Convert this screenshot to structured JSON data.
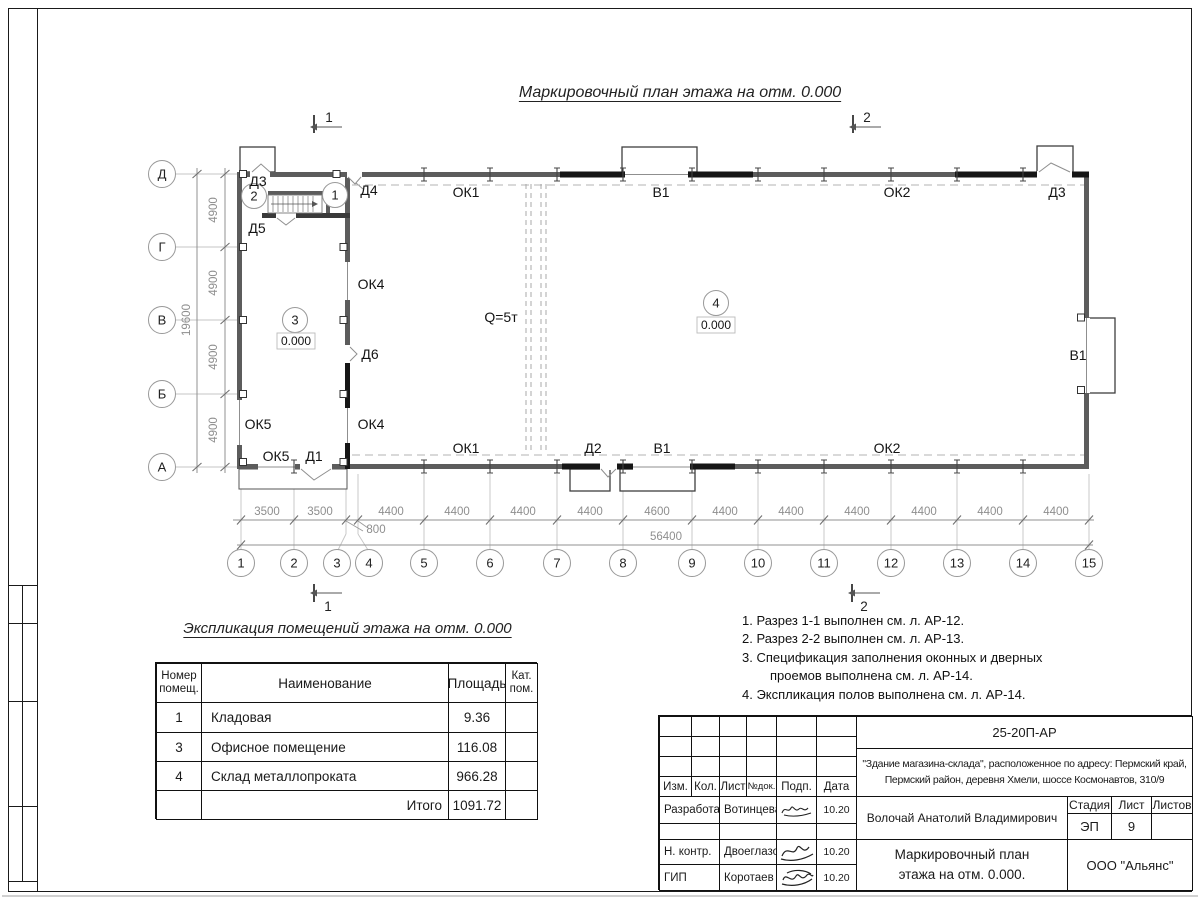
{
  "titles": {
    "plan": "Маркировочный план этажа на отм. 0.000",
    "table": "Экспликация помещений этажа на отм. 0.000"
  },
  "plan": {
    "row_axes": [
      "Д",
      "Г",
      "В",
      "Б",
      "А"
    ],
    "col_axes": [
      "1",
      "2",
      "3",
      "4",
      "5",
      "6",
      "7",
      "8",
      "9",
      "10",
      "11",
      "12",
      "13",
      "14",
      "15"
    ],
    "dims_left": [
      "4900",
      "4900",
      "4900",
      "4900"
    ],
    "dim_left_total": "19600",
    "dims_bottom": [
      "3500",
      "3500",
      "4400",
      "4400",
      "4400",
      "4400",
      "4600",
      "4400",
      "4400",
      "4400",
      "4400",
      "4400",
      "4400"
    ],
    "dim_offset": "800",
    "dim_bottom_total": "56400",
    "labels": {
      "ok1": "ОК1",
      "ok2": "ОК2",
      "ok4": "ОК4",
      "ok5": "ОК5",
      "v1": "В1",
      "d1": "Д1",
      "d2": "Д2",
      "d3": "Д3",
      "d4": "Д4",
      "d5": "Д5",
      "d6": "Д6",
      "crane": "Q=5т",
      "level": "0.000"
    },
    "rooms": [
      "1",
      "2",
      "3",
      "4"
    ],
    "sections": {
      "s1": "1",
      "s2": "2"
    }
  },
  "table": {
    "headers": {
      "num": "Номер помещ.",
      "name": "Наименование",
      "area": "Площадь",
      "cat": "Кат. пом."
    },
    "rows": [
      {
        "num": "1",
        "name": "Кладовая",
        "area": "9.36",
        "cat": ""
      },
      {
        "num": "3",
        "name": "Офисное помещение",
        "area": "116.08",
        "cat": ""
      },
      {
        "num": "4",
        "name": "Склад металлопроката",
        "area": "966.28",
        "cat": ""
      }
    ],
    "total_label": "Итого",
    "total_value": "1091.72"
  },
  "notes": {
    "items": [
      "1. Разрез 1-1 выполнен см. л. АР-12.",
      "2. Разрез 2-2 выполнен см. л. АР-13.",
      "3. Спецификация заполнения оконных и дверных проемов выполнена см. л. АР-14.",
      "4. Экспликация полов выполнена см. л. АР-14."
    ]
  },
  "titleblock": {
    "doc_number": "25-20П-АР",
    "project_lines": [
      "\"Здание магазина-склада\", расположенное по адресу: Пермский край,",
      "Пермский район, деревня Хмели, шоссе Космонавтов, 310/9"
    ],
    "cols": {
      "izm": "Изм.",
      "kol": "Кол.",
      "list": "Лист",
      "ndok": "№док.",
      "podp": "Подп.",
      "data": "Дата"
    },
    "rows": [
      {
        "role": "Разработал",
        "name": "Вотинцева",
        "date": "10.20"
      },
      {
        "role": "Н. контр.",
        "name": "Двоеглазов",
        "date": "10.20"
      },
      {
        "role": "ГИП",
        "name": "Коротаев",
        "date": "10.20"
      }
    ],
    "client": "Волочай Анатолий Владимирович",
    "stage_label": "Стадия",
    "list_label": "Лист",
    "listov_label": "Листов",
    "stage": "ЭП",
    "list_num": "9",
    "listov_num": "",
    "drawing_title_lines": [
      "Маркировочный план",
      "этажа на отм. 0.000."
    ],
    "org": "ООО \"Альянс\""
  }
}
